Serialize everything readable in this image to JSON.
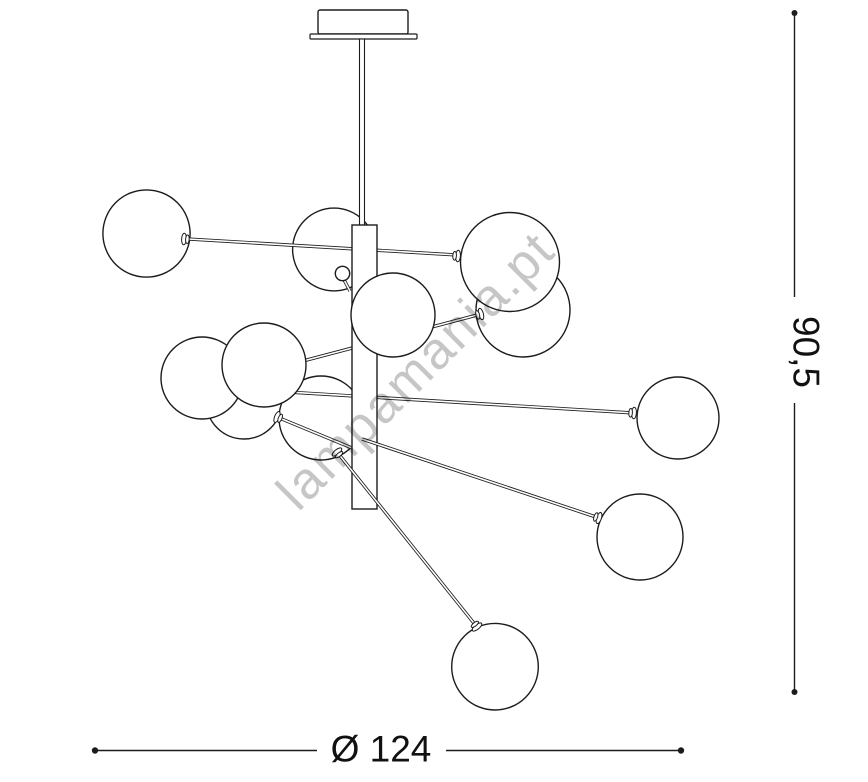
{
  "watermark": {
    "text": "lampamania.pt"
  },
  "dimensions": {
    "width_label": "Ø 124",
    "height_label": "90,5",
    "line_color": "#1c1c1c",
    "text_color": "#111111"
  },
  "figure": {
    "description": "technical line drawing of a 12-globe chandelier with central column and radiating arms",
    "stroke_color": "#1c1c1c",
    "fill_color": "#ffffff",
    "ops": [
      {
        "t": "rect",
        "name": "canopy-box",
        "x": 318,
        "y": 10,
        "w": 90,
        "h": 24,
        "rx": 2,
        "sw": 1.4
      },
      {
        "t": "rect",
        "name": "canopy-plate",
        "x": 310,
        "y": 34,
        "w": 107,
        "h": 5,
        "rx": 1,
        "sw": 1.2
      },
      {
        "t": "circle",
        "name": "globe",
        "cx": 146.5,
        "cy": 233.5,
        "r": 43.6
      },
      {
        "t": "circle",
        "name": "globe",
        "cx": 334,
        "cy": 249.5,
        "r": 41.4
      },
      {
        "t": "rect",
        "name": "stem-rod",
        "x": 359.5,
        "y": 39,
        "w": 5,
        "h": 187,
        "rx": 0,
        "sw": 1.1
      },
      {
        "t": "rod",
        "name": "arm",
        "x1": 188,
        "y1": 239,
        "x2": 457,
        "y2": 255
      },
      {
        "t": "circle",
        "name": "globe",
        "cx": 244,
        "cy": 401,
        "r": 38
      },
      {
        "t": "circle",
        "name": "globe",
        "cx": 321,
        "cy": 418,
        "r": 42
      },
      {
        "t": "rod",
        "name": "arm",
        "x1": 238,
        "y1": 389,
        "x2": 634,
        "y2": 413
      },
      {
        "t": "rod",
        "name": "arm",
        "x1": 303,
        "y1": 361,
        "x2": 481,
        "y2": 314
      },
      {
        "t": "rod",
        "name": "arm",
        "x1": 277,
        "y1": 417,
        "x2": 352,
        "y2": 448
      },
      {
        "t": "rect",
        "name": "column",
        "x": 352,
        "y": 225,
        "w": 25,
        "h": 284,
        "rx": 0,
        "sw": 1.4
      },
      {
        "t": "rod",
        "name": "arm-stub",
        "x1": 350,
        "y1": 291,
        "x2": 343,
        "y2": 278
      },
      {
        "t": "circle",
        "name": "knob",
        "cx": 342.5,
        "cy": 273.5,
        "r": 7.2
      },
      {
        "t": "circle",
        "name": "globe",
        "cx": 393,
        "cy": 315,
        "r": 42
      },
      {
        "t": "rod",
        "name": "arm",
        "x1": 362,
        "y1": 439,
        "x2": 599,
        "y2": 518
      },
      {
        "t": "rod",
        "name": "arm",
        "x1": 337,
        "y1": 452,
        "x2": 477,
        "y2": 627
      },
      {
        "t": "circle",
        "name": "globe",
        "cx": 202,
        "cy": 378,
        "r": 41
      },
      {
        "t": "circle",
        "name": "globe",
        "cx": 264,
        "cy": 365,
        "r": 42
      },
      {
        "t": "ferrule",
        "name": "arm-ferrule",
        "x": 277,
        "y": 417,
        "a": 22.5
      },
      {
        "t": "ferrule",
        "name": "arm-ferrule",
        "x": 337,
        "y": 452,
        "a": 51.3
      },
      {
        "t": "circle",
        "name": "globe",
        "cx": 523,
        "cy": 310,
        "r": 47
      },
      {
        "t": "circle",
        "name": "globe",
        "cx": 510,
        "cy": 262,
        "r": 49.5
      },
      {
        "t": "ferrule",
        "name": "arm-ferrule",
        "x": 481,
        "y": 314,
        "a": 165.2
      },
      {
        "t": "ferrule",
        "name": "arm-ferrule",
        "x": 458,
        "y": 256,
        "a": 183.6
      },
      {
        "t": "ferrule",
        "name": "arm-ferrule",
        "x": 184,
        "y": 239,
        "a": 3.6
      },
      {
        "t": "circle",
        "name": "globe",
        "cx": 678,
        "cy": 418,
        "r": 41
      },
      {
        "t": "ferrule",
        "name": "arm-ferrule",
        "x": 634,
        "y": 413,
        "a": 183.5
      },
      {
        "t": "circle",
        "name": "globe",
        "cx": 640,
        "cy": 537,
        "r": 43
      },
      {
        "t": "ferrule",
        "name": "arm-ferrule",
        "x": 599,
        "y": 518,
        "a": 198.4
      },
      {
        "t": "circle",
        "name": "globe",
        "cx": 495,
        "cy": 666.7,
        "r": 43.3
      },
      {
        "t": "ferrule",
        "name": "arm-ferrule",
        "x": 477,
        "y": 627,
        "a": 231.3
      }
    ],
    "width_dim": {
      "y": 750.5,
      "seg1": [
        95,
        317
      ],
      "seg2": [
        446,
        681
      ],
      "dot_r": 3.2,
      "label_x": 381,
      "label_y": 749
    },
    "height_dim": {
      "x": 794.5,
      "seg1": [
        13,
        297
      ],
      "seg2": [
        403,
        692
      ],
      "dot_r": 3,
      "label_x": 806,
      "label_y": 352
    },
    "watermark_pos": {
      "x": 428,
      "y": 383,
      "angle": -45
    }
  }
}
